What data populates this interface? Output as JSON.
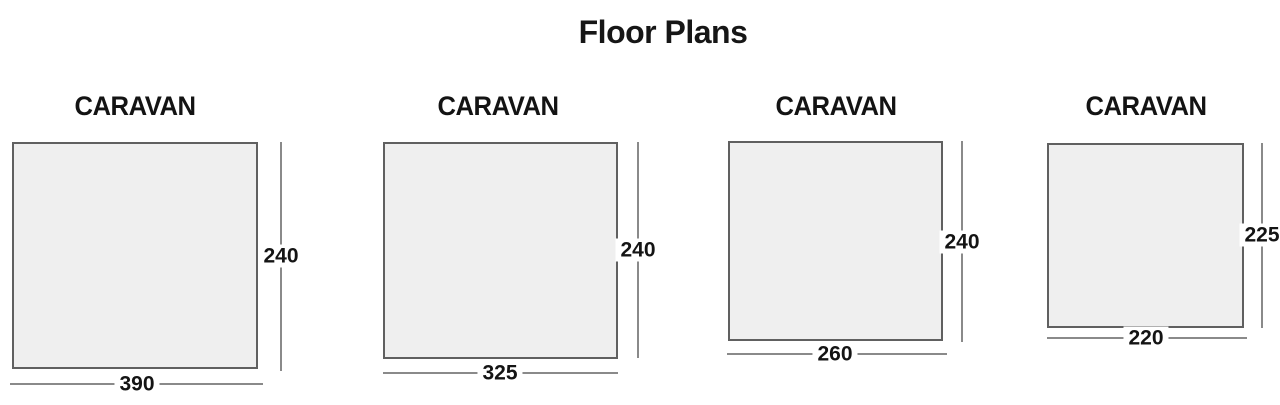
{
  "title": "Floor Plans",
  "plans": [
    {
      "label": "CARAVAN",
      "width": "390",
      "height": "240"
    },
    {
      "label": "CARAVAN",
      "width": "325",
      "height": "240"
    },
    {
      "label": "CARAVAN",
      "width": "260",
      "height": "240"
    },
    {
      "label": "CARAVAN",
      "width": "220",
      "height": "225"
    }
  ],
  "colors": {
    "background": "#ffffff",
    "rect_fill": "#efefef",
    "rect_border": "#606060",
    "dimension_line": "#8a8a8a",
    "text": "#141414"
  }
}
